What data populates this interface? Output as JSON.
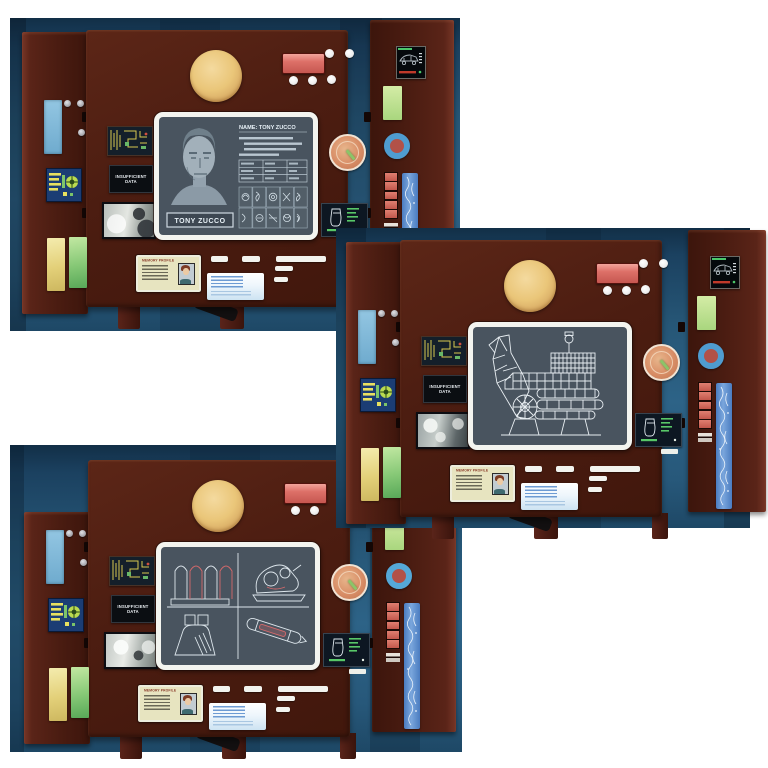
{
  "scene": {
    "description": "Product photo: three dark-red retro computer console playset panels with opened side doors, photographed on a blue backdrop over white",
    "background_color": "#ffffff",
    "backdrop_blue": "#2a5f80",
    "panel_maroon": "#4c1d11"
  },
  "labels": {
    "insufficient_line1": "INSUFFICIENT",
    "insufficient_line2": "DATA",
    "memory_card_title": "MEMORY PROFILE",
    "profile_header": "NAME: TONY ZUCCO",
    "profile_name_plate": "TONY ZUCCO"
  },
  "consoles": [
    {
      "name": "suspect-profile-console",
      "screen_content": "Suspect profile: gray portrait, NAME: TONY ZUCCO header, stats table and grid of record thumbnails"
    },
    {
      "name": "machine-schematic-console",
      "screen_content": "White wireframe schematic of a tracked drilling machine with raised boom arm"
    },
    {
      "name": "equipment-schematic-console",
      "screen_content": "Four-quadrant wireframe schematics: capsule tubes, scanner device, console box, hand tool with red accents"
    }
  ],
  "colors": {
    "screen_slate": "#49545f",
    "gold_disc": "#eac679",
    "red_button": "#dd7068",
    "dial_orange": "#d88d66",
    "dial_pointer_green": "#8cc468",
    "accent_yellow": "#e3d079",
    "accent_green": "#86c876",
    "accent_blue": "#6fabce",
    "ring_blue": "#4f9cd0",
    "ring_center_red": "#b25148",
    "wireframe_white": "#e8eef2",
    "wireframe_red": "#d4696b"
  }
}
